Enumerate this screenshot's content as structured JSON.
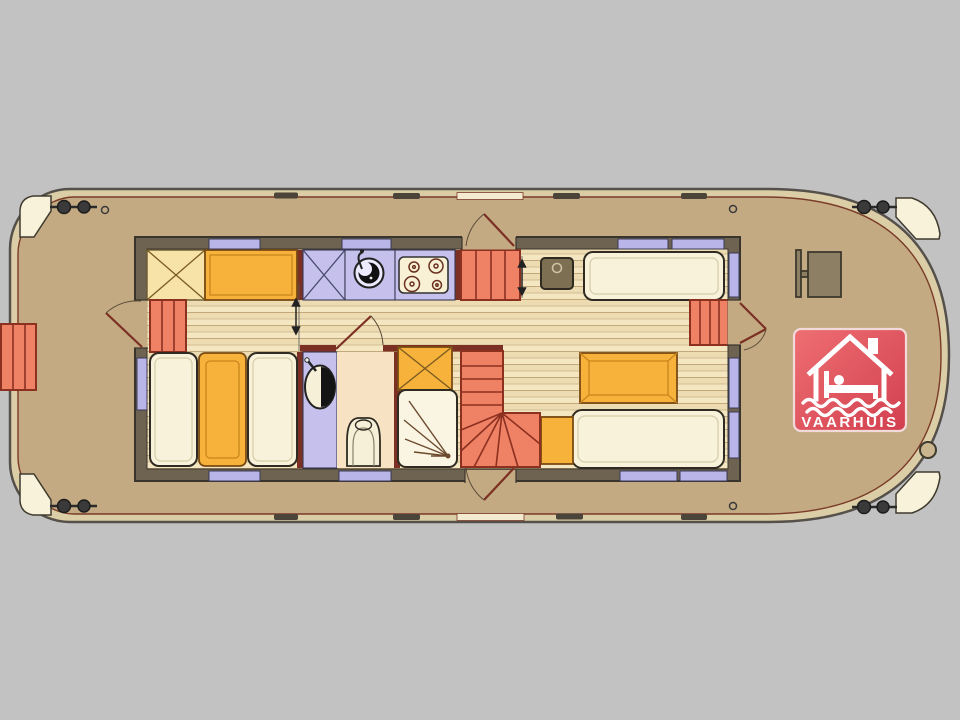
{
  "logo": {
    "text": "VAARHUIS"
  },
  "colors": {
    "bg": "#c2c2c2",
    "gunwale": "#dbcda6",
    "deck": "#c3aa82",
    "hull_line": "#55504a",
    "accent_line": "#7a3b28",
    "wall": "#6e6250",
    "floor": "#f2e3bd",
    "floor_line": "#c2a87a",
    "cream": "#f8f2da",
    "cream_yellow": "#f7e3a8",
    "amber": "#f6b23a",
    "amber_line": "#7a4a12",
    "salmon": "#ef8165",
    "salmon_line": "#8c3020",
    "lavender": "#c5c1ec",
    "window": "#b9b5e8",
    "red_wall": "#7c2f23",
    "peach": "#f8e2c4",
    "fixture_white": "#f7f0d8",
    "dark_brown": "#8d7f63",
    "heater": "#7d6f52",
    "logo_red_1": "#ee6f72",
    "logo_red_2": "#d23f4f"
  }
}
